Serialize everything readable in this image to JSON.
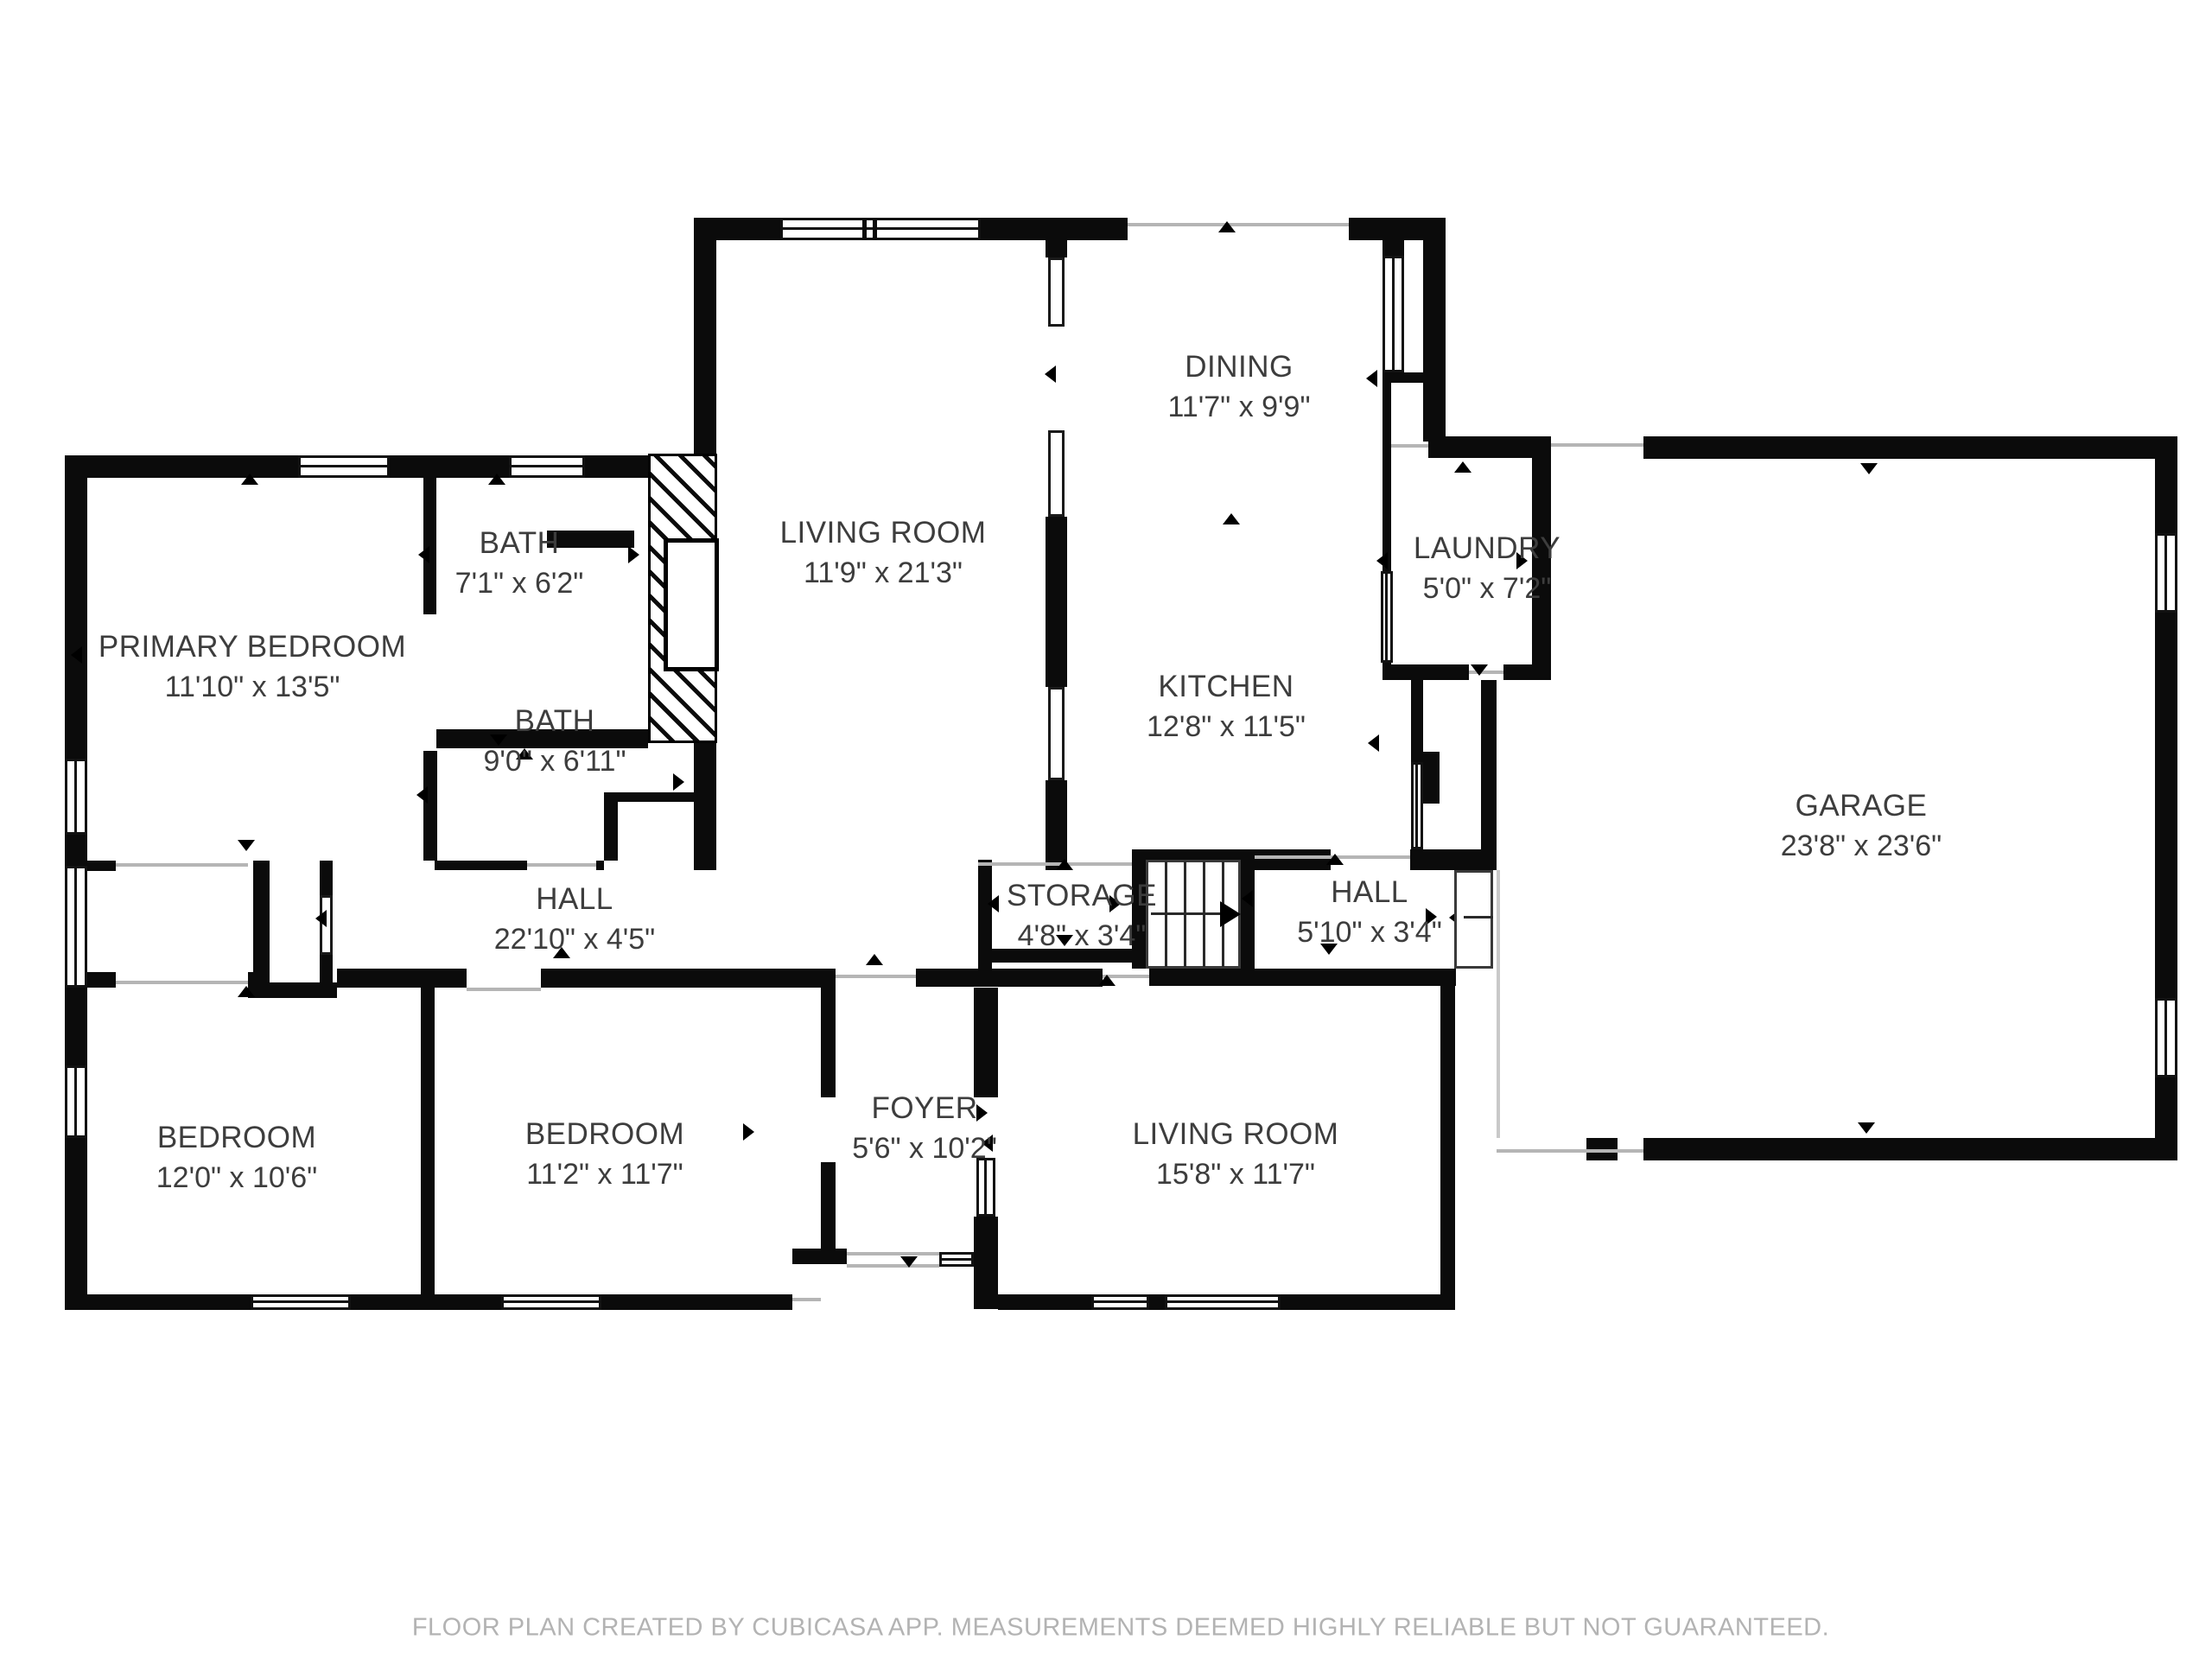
{
  "document": {
    "type": "floor-plan",
    "footer": "FLOOR PLAN CREATED BY CUBICASA APP. MEASUREMENTS DEEMED HIGHLY RELIABLE BUT NOT GUARANTEED."
  },
  "colors": {
    "wall": "#0b0b0b",
    "opening_line": "#b5b5b5",
    "label_text": "#3d3d3d",
    "footer_text": "#b3b3b3",
    "background": "#ffffff"
  },
  "rooms": [
    {
      "id": "primary_bedroom",
      "name": "PRIMARY BEDROOM",
      "dims": "11'10\" x 13'5\""
    },
    {
      "id": "bath_upper",
      "name": "BATH",
      "dims": "7'1\" x 6'2\""
    },
    {
      "id": "bath_lower",
      "name": "BATH",
      "dims": "9'0\" x 6'11\""
    },
    {
      "id": "living_room_upper",
      "name": "LIVING ROOM",
      "dims": "11'9\" x 21'3\""
    },
    {
      "id": "dining",
      "name": "DINING",
      "dims": "11'7\" x 9'9\""
    },
    {
      "id": "kitchen",
      "name": "KITCHEN",
      "dims": "12'8\" x 11'5\""
    },
    {
      "id": "laundry",
      "name": "LAUNDRY",
      "dims": "5'0\" x 7'2\""
    },
    {
      "id": "garage",
      "name": "GARAGE",
      "dims": "23'8\" x 23'6\""
    },
    {
      "id": "hall_main",
      "name": "HALL",
      "dims": "22'10\" x 4'5\""
    },
    {
      "id": "storage",
      "name": "STORAGE",
      "dims": "4'8\" x 3'4\""
    },
    {
      "id": "hall_side",
      "name": "HALL",
      "dims": "5'10\" x 3'4\""
    },
    {
      "id": "bedroom_left",
      "name": "BEDROOM",
      "dims": "12'0\" x 10'6\""
    },
    {
      "id": "bedroom_middle",
      "name": "BEDROOM",
      "dims": "11'2\" x 11'7\""
    },
    {
      "id": "foyer",
      "name": "FOYER",
      "dims": "5'6\" x 10'2\""
    },
    {
      "id": "living_room_lower",
      "name": "LIVING ROOM",
      "dims": "15'8\" x 11'7\""
    }
  ],
  "stairs": {
    "treads": 5,
    "arrow_direction": "right"
  }
}
